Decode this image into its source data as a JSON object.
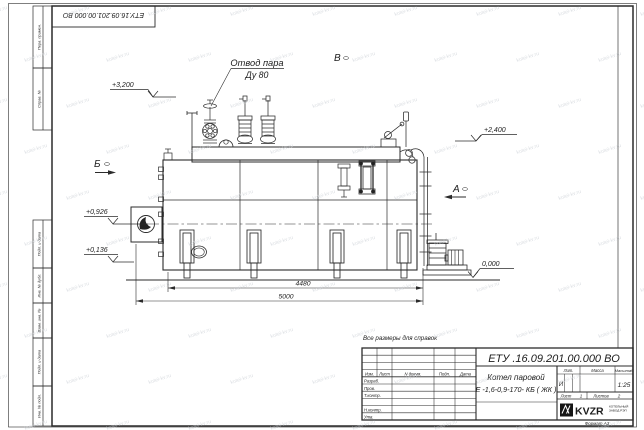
{
  "sheet": {
    "watermark_text": "kotel-kv.ru",
    "format_label": "Формат А3",
    "reference_note": "Все размеры для справок"
  },
  "frame_stamp": {
    "top_document_number": "ЕТУ.16.09.201.00.000  ВО",
    "left_labels": {
      "perv_primen": "Перв. примен.",
      "sprav_no": "Справ. №",
      "podp_data_top": "Подп. и дата",
      "inv_dubl": "Инв. № дубл.",
      "vzam_inv": "Взам. инв. №",
      "podp_data_bottom": "Подп. и дата",
      "inv_podl": "Инв. № подл."
    }
  },
  "drawing": {
    "callout": {
      "line1": "Отвод пара",
      "line2": "Ду 80"
    },
    "elevations": {
      "m3200": "+3,200",
      "m2400": "+2,400",
      "m0926": "+0,926",
      "m0136": "+0,136",
      "zero": "0,000"
    },
    "dimensions": {
      "boiler_length": "4480",
      "overall_length": "5000"
    },
    "views": {
      "b": "Б",
      "v": "В",
      "a": "А"
    }
  },
  "title_block": {
    "document_number": "ЕТУ .16.09.201.00.000  ВО",
    "product_name": "Котел паровой",
    "product_model": "Е -1,6-0,9-170- КБ ( ЖК )",
    "header": {
      "izm": "Изм.",
      "list": "Лист",
      "n_dokum": "N докум.",
      "podp": "Подп.",
      "data": "Дата"
    },
    "roles": {
      "razrab": "Разраб.",
      "prov": "Пров.",
      "t_kontr": "Т.контр.",
      "n_kontr": "Н.контр.",
      "utv": "Утв."
    },
    "lit": {
      "label": "Лит.",
      "value": "И"
    },
    "massa": {
      "label": "Масса",
      "value": ""
    },
    "masshtab": {
      "label": "Масштаб",
      "value": "1:25"
    },
    "sheet_no": {
      "label": "Лист",
      "value": "1"
    },
    "sheets_total": {
      "label": "Листов",
      "value": "2"
    },
    "company": {
      "logo": "KVZR",
      "sub1": "КОТЕЛЬНЫЙ",
      "sub2": "ЗАВОД РЭП"
    }
  }
}
